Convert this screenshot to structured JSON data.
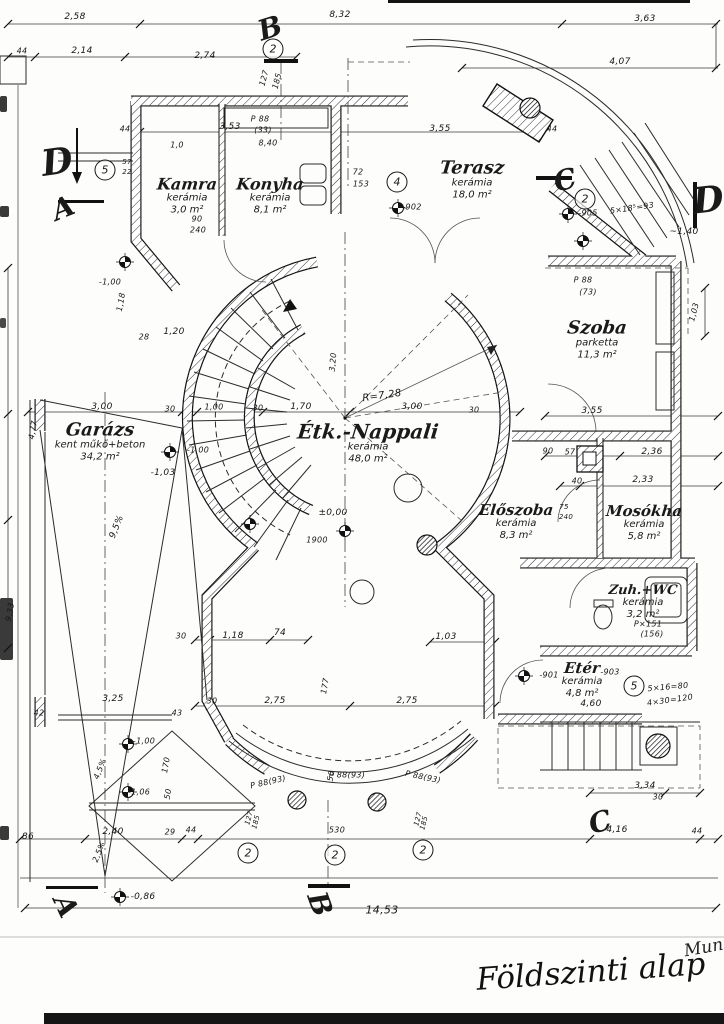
{
  "title": {
    "main": "Földszinti alap",
    "note": "Mun"
  },
  "rooms": [
    {
      "name": "Kamra",
      "material": "kerámia",
      "area": "3,0 m²",
      "x": 187,
      "y": 196,
      "s": 16
    },
    {
      "name": "Konyha",
      "material": "kerámia",
      "area": "8,1 m²",
      "x": 270,
      "y": 196,
      "s": 16
    },
    {
      "name": "Terasz",
      "material": "kerámia",
      "area": "18,0 m²",
      "x": 472,
      "y": 180,
      "s": 18
    },
    {
      "name": "Szoba",
      "material": "parketta",
      "area": "11,3 m²",
      "x": 597,
      "y": 340,
      "s": 18
    },
    {
      "name": "Étk.-Nappali",
      "material": "kerámia",
      "area": "48,0 m²",
      "x": 368,
      "y": 443,
      "s": 20
    },
    {
      "name": "Garázs",
      "material": "kent műkő+beton",
      "area": "34,2 m²",
      "x": 100,
      "y": 442,
      "s": 18
    },
    {
      "name": "Előszoba",
      "material": "kerámia",
      "area": "8,3 m²",
      "x": 516,
      "y": 522,
      "s": 15
    },
    {
      "name": "Mosókha",
      "material": "kerámia",
      "area": "5,8 m²",
      "x": 644,
      "y": 523,
      "s": 15
    },
    {
      "name": "Zuh.+WC",
      "material": "kerámia",
      "area": "3,2 m²",
      "x": 643,
      "y": 602,
      "s": 13
    },
    {
      "name": "Etér",
      "material": "kerámia",
      "area": "4,8 m²",
      "x": 582,
      "y": 680,
      "s": 15
    }
  ],
  "section_markers": [
    {
      "letter": "D",
      "x": 57,
      "y": 162,
      "s": 36,
      "r": -8
    },
    {
      "letter": "A",
      "x": 63,
      "y": 208,
      "s": 28,
      "r": -22
    },
    {
      "letter": "B",
      "x": 270,
      "y": 28,
      "s": 28,
      "r": -18
    },
    {
      "letter": "C",
      "x": 565,
      "y": 180,
      "s": 28,
      "r": -14
    },
    {
      "letter": "D",
      "x": 708,
      "y": 200,
      "s": 36,
      "r": -6
    },
    {
      "letter": "C",
      "x": 600,
      "y": 822,
      "s": 28,
      "r": -15
    },
    {
      "letter": "A",
      "x": 66,
      "y": 906,
      "s": 28,
      "r": 65
    },
    {
      "letter": "B",
      "x": 320,
      "y": 904,
      "s": 28,
      "r": 70
    }
  ],
  "circled_numbers": [
    {
      "n": "2",
      "x": 273,
      "y": 49
    },
    {
      "n": "5",
      "x": 105,
      "y": 170
    },
    {
      "n": "4",
      "x": 397,
      "y": 182
    },
    {
      "n": "2",
      "x": 585,
      "y": 199
    },
    {
      "n": "5",
      "x": 634,
      "y": 686
    },
    {
      "n": "2",
      "x": 248,
      "y": 853
    },
    {
      "n": "2",
      "x": 335,
      "y": 855
    },
    {
      "n": "2",
      "x": 423,
      "y": 850
    }
  ],
  "dim_labels": [
    {
      "t": "2,58",
      "x": 75,
      "y": 17
    },
    {
      "t": "8,32",
      "x": 340,
      "y": 15
    },
    {
      "t": "3,63",
      "x": 645,
      "y": 19
    },
    {
      "t": "44",
      "x": 22,
      "y": 51,
      "s": 8
    },
    {
      "t": "2,14",
      "x": 82,
      "y": 51
    },
    {
      "t": "2,74",
      "x": 205,
      "y": 56
    },
    {
      "t": "4,07",
      "x": 620,
      "y": 62
    },
    {
      "t": "127",
      "x": 264,
      "y": 78,
      "r": -75,
      "s": 8
    },
    {
      "t": "185",
      "x": 277,
      "y": 81,
      "r": -75,
      "s": 8
    },
    {
      "t": "44",
      "x": 125,
      "y": 129,
      "s": 8
    },
    {
      "t": "3,53",
      "x": 230,
      "y": 127
    },
    {
      "t": "3,55",
      "x": 440,
      "y": 129
    },
    {
      "t": "1,0",
      "x": 177,
      "y": 145,
      "s": 8
    },
    {
      "t": "P 88",
      "x": 260,
      "y": 119,
      "s": 8
    },
    {
      "t": "(33)",
      "x": 263,
      "y": 130,
      "s": 8
    },
    {
      "t": "8,40",
      "x": 268,
      "y": 143,
      "s": 8
    },
    {
      "t": "72",
      "x": 358,
      "y": 172,
      "s": 8
    },
    {
      "t": "153",
      "x": 361,
      "y": 184,
      "s": 8
    },
    {
      "t": "-902",
      "x": 412,
      "y": 207,
      "s": 8
    },
    {
      "t": "44",
      "x": 552,
      "y": 129,
      "s": 8
    },
    {
      "t": "57",
      "x": 127,
      "y": 162,
      "s": 7
    },
    {
      "t": "22",
      "x": 127,
      "y": 172,
      "s": 7
    },
    {
      "t": "90",
      "x": 197,
      "y": 219,
      "s": 8
    },
    {
      "t": "240",
      "x": 198,
      "y": 230,
      "s": 8
    },
    {
      "t": "-905",
      "x": 588,
      "y": 213,
      "s": 8
    },
    {
      "t": "5×18⁵=93",
      "x": 632,
      "y": 208,
      "r": -8,
      "s": 8
    },
    {
      "t": "~1,40",
      "x": 684,
      "y": 232
    },
    {
      "t": "P 88",
      "x": 583,
      "y": 280,
      "s": 8
    },
    {
      "t": "(73)",
      "x": 588,
      "y": 292,
      "s": 8
    },
    {
      "t": "1,03",
      "x": 694,
      "y": 312,
      "r": -75,
      "s": 8
    },
    {
      "t": "3,55",
      "x": 592,
      "y": 411
    },
    {
      "t": "90",
      "x": 548,
      "y": 451,
      "s": 8
    },
    {
      "t": "57",
      "x": 570,
      "y": 452,
      "s": 8
    },
    {
      "t": "2,36",
      "x": 652,
      "y": 452
    },
    {
      "t": "40",
      "x": 577,
      "y": 481,
      "s": 8
    },
    {
      "t": "2,33",
      "x": 643,
      "y": 480
    },
    {
      "t": "75",
      "x": 564,
      "y": 507,
      "s": 7
    },
    {
      "t": "240",
      "x": 566,
      "y": 517,
      "s": 7
    },
    {
      "t": "R=7,28",
      "x": 382,
      "y": 396,
      "r": -8,
      "s": 10
    },
    {
      "t": "1,70",
      "x": 301,
      "y": 407
    },
    {
      "t": "3,00",
      "x": 412,
      "y": 407
    },
    {
      "t": "30",
      "x": 474,
      "y": 410,
      "s": 8
    },
    {
      "t": "3,00",
      "x": 102,
      "y": 407
    },
    {
      "t": "30",
      "x": 170,
      "y": 409,
      "s": 8
    },
    {
      "t": "1,00",
      "x": 214,
      "y": 407,
      "s": 8
    },
    {
      "t": "30",
      "x": 258,
      "y": 408,
      "s": 8
    },
    {
      "t": "3,20",
      "x": 333,
      "y": 362,
      "r": -85,
      "s": 8
    },
    {
      "t": "±0,00",
      "x": 333,
      "y": 513
    },
    {
      "t": "1900",
      "x": 317,
      "y": 540,
      "s": 8
    },
    {
      "t": "-1,00",
      "x": 110,
      "y": 282,
      "s": 8
    },
    {
      "t": "1,18",
      "x": 121,
      "y": 302,
      "r": -80,
      "s": 8
    },
    {
      "t": "28",
      "x": 144,
      "y": 337,
      "s": 8
    },
    {
      "t": "1,20",
      "x": 174,
      "y": 332
    },
    {
      "t": "-1,03",
      "x": 163,
      "y": 473
    },
    {
      "t": "-1,00",
      "x": 198,
      "y": 450,
      "s": 8
    },
    {
      "t": "4,77",
      "x": 33,
      "y": 430,
      "r": -80,
      "s": 8
    },
    {
      "t": "9,5%",
      "x": 117,
      "y": 527,
      "r": -68
    },
    {
      "t": "9,33",
      "x": 10,
      "y": 612,
      "r": -80,
      "s": 8
    },
    {
      "t": "30",
      "x": 181,
      "y": 636,
      "s": 8
    },
    {
      "t": "1,18",
      "x": 233,
      "y": 636
    },
    {
      "t": "74",
      "x": 280,
      "y": 633
    },
    {
      "t": "1,03",
      "x": 446,
      "y": 637
    },
    {
      "t": "177",
      "x": 325,
      "y": 686,
      "r": -80,
      "s": 8
    },
    {
      "t": "30",
      "x": 212,
      "y": 701,
      "s": 8
    },
    {
      "t": "2,75",
      "x": 275,
      "y": 701
    },
    {
      "t": "2,75",
      "x": 407,
      "y": 701
    },
    {
      "t": "43",
      "x": 177,
      "y": 713,
      "s": 8
    },
    {
      "t": "42",
      "x": 39,
      "y": 713,
      "s": 8
    },
    {
      "t": "3,25",
      "x": 113,
      "y": 699
    },
    {
      "t": "-1,00",
      "x": 144,
      "y": 741,
      "s": 8
    },
    {
      "t": "-1,06",
      "x": 139,
      "y": 792,
      "s": 8
    },
    {
      "t": "4,5%",
      "x": 100,
      "y": 769,
      "r": -68,
      "s": 8
    },
    {
      "t": "2,5%",
      "x": 99,
      "y": 852,
      "r": -68,
      "s": 8
    },
    {
      "t": "2,40",
      "x": 113,
      "y": 832
    },
    {
      "t": "86",
      "x": 28,
      "y": 837
    },
    {
      "t": "29",
      "x": 170,
      "y": 832,
      "s": 8
    },
    {
      "t": "44",
      "x": 191,
      "y": 830,
      "s": 8
    },
    {
      "t": "170",
      "x": 166,
      "y": 765,
      "r": -80,
      "s": 8
    },
    {
      "t": "50",
      "x": 168,
      "y": 794,
      "r": -80,
      "s": 8
    },
    {
      "t": "P 88(93)",
      "x": 268,
      "y": 782,
      "r": -13,
      "s": 8
    },
    {
      "t": "P 88(93)",
      "x": 347,
      "y": 775,
      "s": 8
    },
    {
      "t": "P 88(93)",
      "x": 423,
      "y": 777,
      "r": 12,
      "s": 8
    },
    {
      "t": "50",
      "x": 331,
      "y": 776,
      "r": -80,
      "s": 8
    },
    {
      "t": "530",
      "x": 337,
      "y": 830,
      "s": 8
    },
    {
      "t": "127",
      "x": 249,
      "y": 818,
      "r": -75,
      "s": 7
    },
    {
      "t": "185",
      "x": 256,
      "y": 822,
      "r": -75,
      "s": 7
    },
    {
      "t": "127",
      "x": 418,
      "y": 819,
      "r": -75,
      "s": 7
    },
    {
      "t": "185",
      "x": 424,
      "y": 823,
      "r": -75,
      "s": 7
    },
    {
      "t": "4,16",
      "x": 617,
      "y": 830
    },
    {
      "t": "44",
      "x": 697,
      "y": 831,
      "s": 8
    },
    {
      "t": "3,34",
      "x": 645,
      "y": 786
    },
    {
      "t": "30",
      "x": 658,
      "y": 797,
      "s": 8
    },
    {
      "t": "14,53",
      "x": 382,
      "y": 910,
      "s": 11
    },
    {
      "t": "-0,86",
      "x": 143,
      "y": 897
    },
    {
      "t": "-901",
      "x": 549,
      "y": 675,
      "s": 8
    },
    {
      "t": "-903",
      "x": 610,
      "y": 672,
      "s": 8
    },
    {
      "t": "5×16=80",
      "x": 668,
      "y": 687,
      "r": -5,
      "s": 8
    },
    {
      "t": "4×30=120",
      "x": 670,
      "y": 700,
      "r": -8,
      "s": 8
    },
    {
      "t": "4,60",
      "x": 591,
      "y": 704
    },
    {
      "t": "P×151",
      "x": 648,
      "y": 624,
      "s": 8
    },
    {
      "t": "(156)",
      "x": 652,
      "y": 634,
      "s": 8
    }
  ]
}
